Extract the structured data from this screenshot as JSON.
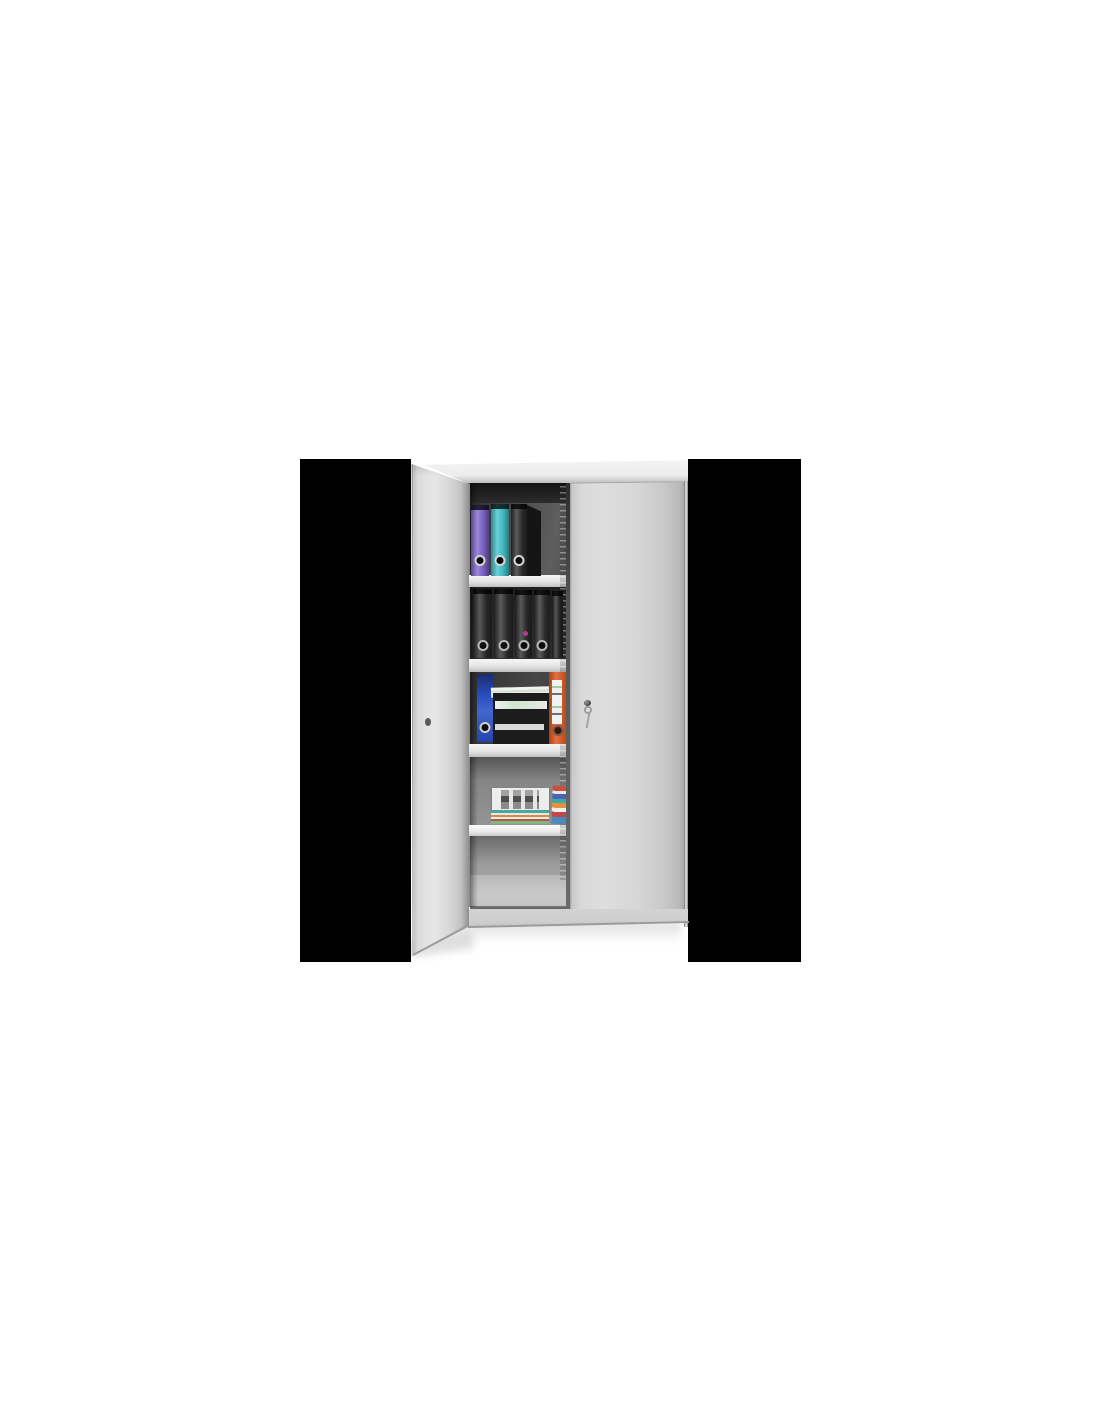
{
  "image": {
    "description": "Product photograph of a light grey steel storage cabinet with two hinged doors. The left door is open, revealing five shelf compartments containing ring binders, black letter trays with papers and stacks of documents. A key with a ring hangs in the lock of the closed right door. The square product image has black pillarbox bars on both sides and sits centered on a white page.",
    "visible_text": ""
  },
  "theme": {
    "page_bg": "#ffffff",
    "bar": "#000000",
    "cab_face": "#dedede",
    "cab_top": "#ececec",
    "shelf": "#e4e4e4",
    "floor": "#c9c9c9",
    "base": "#d3d3d3",
    "blue_binder": "#2a50c8",
    "orange_binder": "#e2571e",
    "tray": "#1c1c1c"
  },
  "binder_rows": {
    "row1": {
      "items": [
        {
          "left": 60,
          "top": 46,
          "width": 18,
          "height": 71,
          "color": "#7e66ce",
          "hole": "light"
        },
        {
          "left": 80,
          "top": 45,
          "width": 18,
          "height": 72,
          "color": "#41c4ca",
          "hole": "light"
        },
        {
          "left": 100,
          "top": 45,
          "width": 16,
          "height": 72,
          "color": "#2e2e2e",
          "hole": "light"
        }
      ]
    },
    "row2": {
      "items": [
        {
          "left": 62,
          "top": 130,
          "width": 19,
          "height": 69,
          "color": "#2a2a2a",
          "hole": "ring"
        },
        {
          "left": 83,
          "top": 130,
          "width": 19,
          "height": 69,
          "color": "#2d2d2d",
          "hole": "ring"
        },
        {
          "left": 104,
          "top": 131,
          "width": 17,
          "height": 68,
          "color": "#2a2a2a",
          "hole": "ring",
          "sticker": "#b9388f"
        },
        {
          "left": 123,
          "top": 131,
          "width": 16,
          "height": 68,
          "color": "#2e2e2e",
          "hole": "ring"
        },
        {
          "left": 141,
          "top": 132,
          "width": 11,
          "height": 67,
          "color": "#262626"
        }
      ]
    }
  },
  "compartments": [
    {
      "position": "top",
      "contents": [
        "purple ring binder",
        "teal ring binder",
        "black ring binder"
      ]
    },
    {
      "position": "second",
      "contents": [
        "five black ring binders, one with magenta dot sticker"
      ]
    },
    {
      "position": "third",
      "contents": [
        "blue ring binder",
        "black letter tray stack with papers",
        "orange ring binder with white label"
      ]
    },
    {
      "position": "fourth",
      "contents": [
        "stack of documents with printed grid sheet and colored folders",
        "folded colorful papers"
      ]
    },
    {
      "position": "fifth",
      "contents": []
    }
  ],
  "hardware": {
    "lock": "cylinder lock on closed right door",
    "key": "key with ring hanging in lock",
    "keyhole_open_door": "keyhole on inner face of open left door"
  }
}
